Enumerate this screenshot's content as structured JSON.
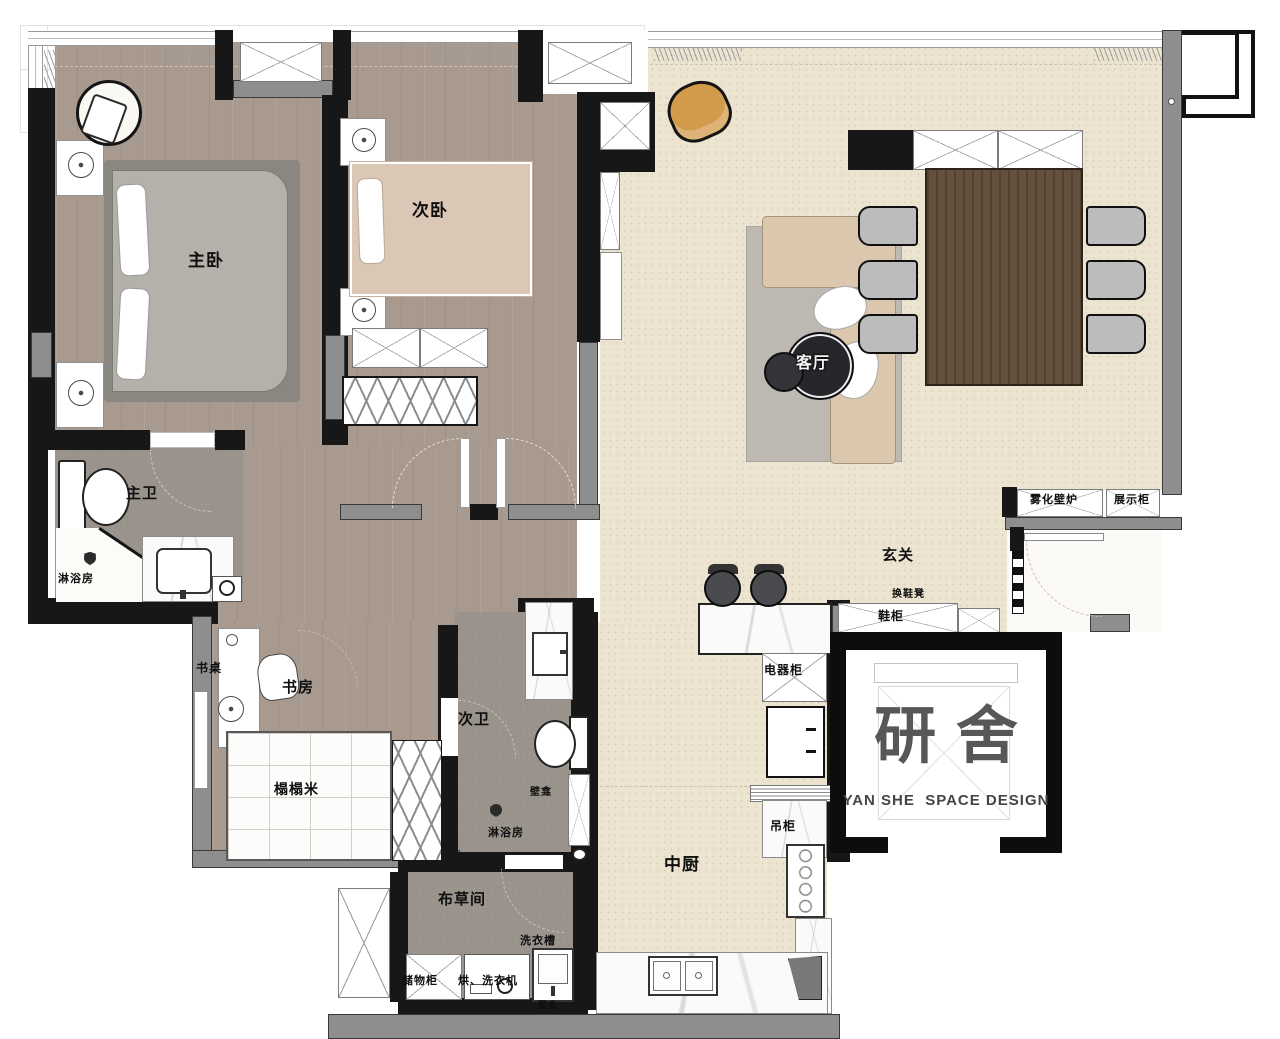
{
  "labels": {
    "master_bedroom": "主卧",
    "second_bedroom": "次卧",
    "master_bath": "主卫",
    "master_shower": "淋浴房",
    "desk": "书桌",
    "study": "书房",
    "tatami": "榻榻米",
    "second_bath": "次卫",
    "niche_a": "壁龛",
    "second_shower": "淋浴房",
    "linen_room": "布草间",
    "laundry_sink": "洗衣槽",
    "storage_cabinet": "储物柜",
    "washer_dryer": "烘、洗衣机",
    "niche_b": "壁龛",
    "kitchen": "中厨",
    "hanging_cabinet": "吊柜",
    "appliance_cabinet": "电器柜",
    "living_room": "客厅",
    "foyer": "玄关",
    "shoe_cabinet": "鞋柜",
    "shoe_bench": "换鞋凳",
    "fog_fireplace": "雾化壁炉",
    "display_cabinet": "展示柜"
  },
  "logo": {
    "name_cn": "研舍",
    "name_en": "YAN SHE  SPACE DESIGN"
  },
  "colors": {
    "wood_floor": "#a89a8f",
    "tile_floor": "#99938c",
    "cream_floor": "#ece4d0",
    "wall_black": "#171717",
    "wall_gray": "#8e8e8e",
    "bed_secondary": "#dbc7b6",
    "sofa_beige": "#dbc7ae",
    "dining_wood": "#64503c",
    "armchair_orange": "#d29a4b",
    "logo_gray": "#575757"
  }
}
